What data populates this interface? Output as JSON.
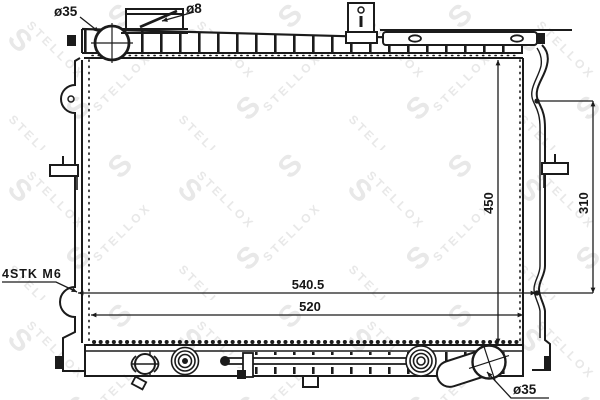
{
  "watermark": {
    "brand": "STELLOX",
    "logo_letter": "S",
    "color": "#e8e8e8"
  },
  "annotations": {
    "inlet_diameter": "ø35",
    "cap_vent_diameter": "ø8",
    "stud_spec": "4STK M6",
    "outlet_diameter": "ø35"
  },
  "dimensions": {
    "overall_width": "540.5",
    "core_width": "520",
    "overall_height": "450",
    "mount_height": "310"
  },
  "colors": {
    "line": "#1b1b1b",
    "background": "#ffffff",
    "watermark": "#e8e8e8"
  }
}
